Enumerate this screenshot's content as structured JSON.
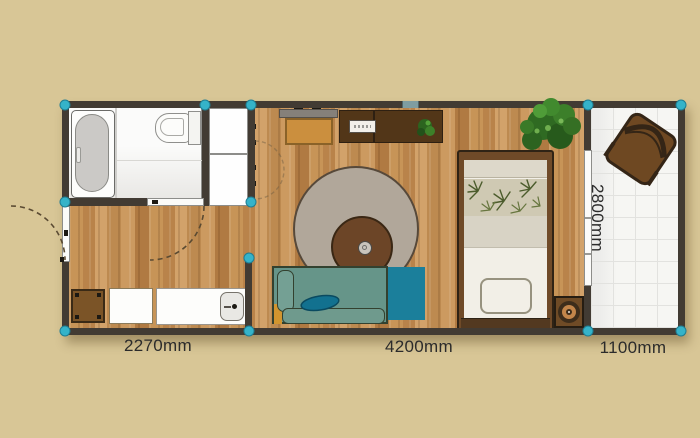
{
  "scene": {
    "type": "floor-plan-editor"
  },
  "dimension_labels": {
    "left_section_width": "2270mm",
    "living_section_width": "4200mm",
    "balcony_width": "1100mm",
    "unit_depth": "2800mm"
  },
  "palette": {
    "background": "#d8c696",
    "wall": "#423b33",
    "corner_handle": "#35b3c9",
    "wood_floor": "#c5955b",
    "bathroom_floor": "#f2f1ee",
    "balcony_floor": "#f5f5f2",
    "sofa_body": "#669589",
    "sofa_accent": "#1b7f9b",
    "rug": "#b1a79a",
    "wood_furniture": "#6f4a28",
    "desk": "#523618",
    "side_table": "#cb8f3e",
    "plant_green": "#3a7a2a",
    "label_text": "#2b2b2b"
  },
  "icons": {
    "corner_handle_count": 12,
    "doors": [
      "entry-door",
      "bathroom-door",
      "balcony-sliding-door"
    ],
    "window_count": 1,
    "furniture": [
      "bathtub",
      "toilet",
      "storage-cabinet",
      "storage-box",
      "washing-machine",
      "kitchen-counter",
      "sink",
      "wall-shelf",
      "side-table",
      "desk",
      "keyboard",
      "desk-plant",
      "round-rug",
      "coffee-table",
      "cup",
      "sofa",
      "sofa-pillow",
      "sofa-chaise",
      "bed",
      "palm-blanket",
      "folded-blanket",
      "speaker",
      "corner-plant",
      "balcony-chair"
    ]
  }
}
